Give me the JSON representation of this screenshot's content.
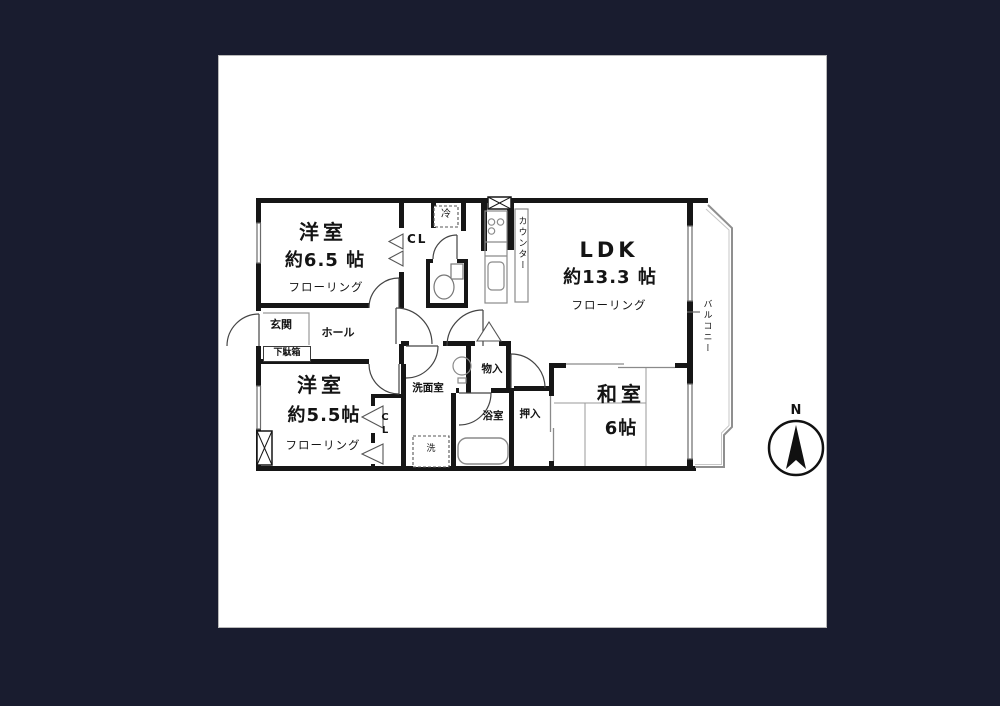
{
  "colors": {
    "canvas_bg": "#191c2f",
    "sheet_bg": "#ffffff",
    "sheet_border": "#b9b9b9",
    "wall": "#161616"
  },
  "rooms": {
    "bedroom1": {
      "name": "洋室",
      "size": "約6.5 帖",
      "floor": "フローリング"
    },
    "ldk": {
      "name": "LDK",
      "size": "約13.3 帖",
      "floor": "フローリング"
    },
    "bedroom2": {
      "name": "洋室",
      "size": "約5.5帖",
      "floor": "フローリング"
    },
    "washitsu": {
      "name": "和室",
      "size": "6帖"
    }
  },
  "labels": {
    "entrance": "玄関",
    "hall": "ホール",
    "shoe_box": "下駄箱",
    "closet_top": "CL",
    "closet_bottom": "CL",
    "refrigerator": "冷",
    "counter": "カウンター",
    "balcony": "バルコニー",
    "washroom": "洗面室",
    "storage": "物入",
    "bathroom": "浴室",
    "oshiire": "押入",
    "washer": "洗"
  },
  "compass": {
    "north": "N"
  }
}
